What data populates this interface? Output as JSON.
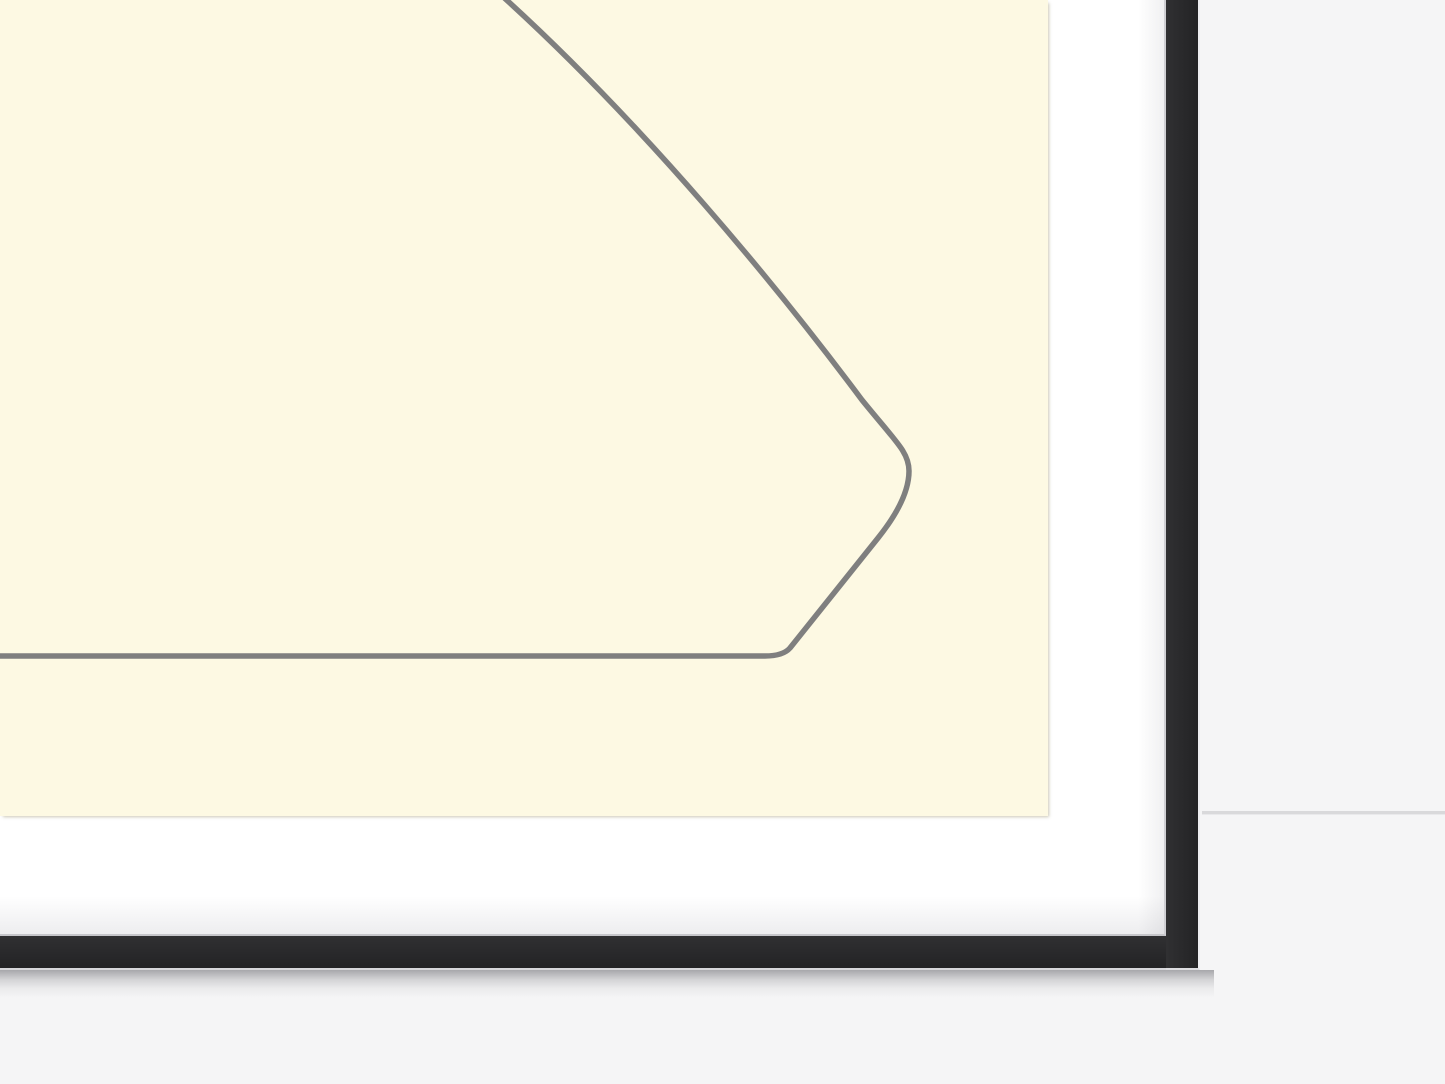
{
  "scene": {
    "title": "Close-up of the bottom-right corner of a black picture frame with a white mat, showing a cream artwork with a gray curved outline drawing",
    "artwork": {
      "paper_color": "#FDF9E3",
      "line_color": "#7F7F7F",
      "line_width": "5.5",
      "line_path": "M 500 -6 C 645 125 780 290 862 400 C 896 442 909 452 909 471 C 909 491 898 513 878 538 L 790 648 Q 783 656 765 656 L -6 656"
    },
    "frame": {
      "moulding_color": "#29292B",
      "mat_color": "#FFFFFF",
      "inner_lip_color": "#CFCFD3",
      "outer_highlight_color": "#EEEEF1"
    },
    "background": {
      "wall_color": "#F5F5F6",
      "divider_color": "#D9D9DB",
      "shadow_color": "rgba(40,40,48,0.38)"
    }
  }
}
